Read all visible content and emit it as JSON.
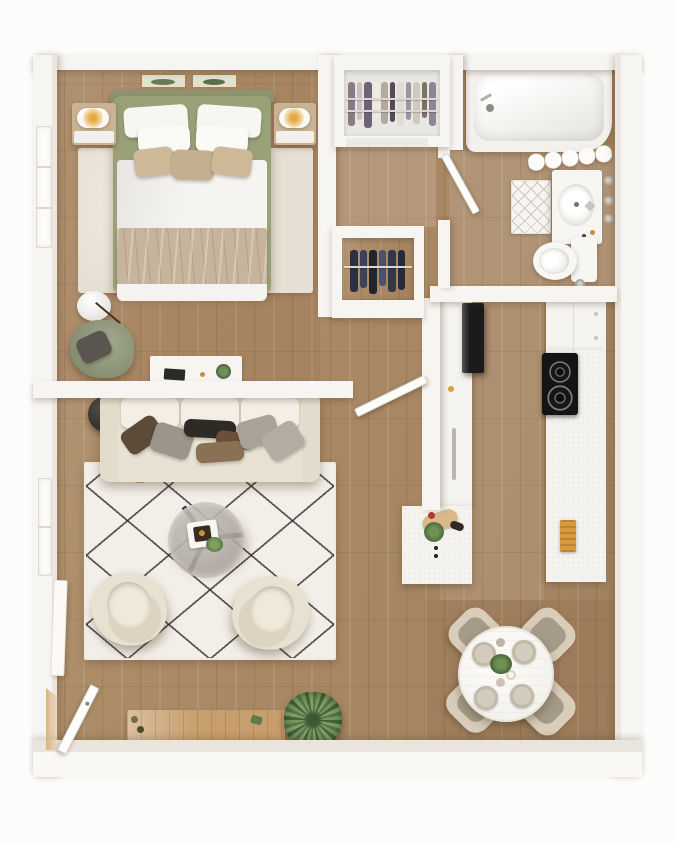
{
  "colors": {
    "page_bg": "#fcfcfb",
    "wall": "#f7f5f2",
    "wall_shade": "#ebe7df",
    "wood_base": "#ac8b67",
    "rug_bedroom": "#e6dfd3",
    "rug_living": "#f2efe8",
    "rug_pattern": "#2a2723",
    "sofa": "#e9e2d4",
    "bed_frame": "#9aa178",
    "bedding": "#f5f4f0",
    "blanket": "#c6b49c",
    "armchair_green": "#8d9674",
    "accent_chair": "#e8e1d2",
    "console_wood": "#c79e6d",
    "plant_green": "#5d7d4c",
    "appliance_dark": "#1b1b1d",
    "towel_orange": "#d89a3e",
    "counter_white": "#f4f3ef",
    "dining_chair": "#d8cdba",
    "table_white": "#f4f2ed",
    "lamp_glow": "#e8a93f",
    "clothes_navy": "#333a4d",
    "door_white": "#fdfdfb"
  },
  "scene": {
    "type": "apartment-floor-plan-3d-top-view",
    "rooms": [
      "bedroom",
      "closet",
      "hallway",
      "walk-in-closet",
      "bathroom",
      "kitchen",
      "living-room",
      "dining-area"
    ],
    "bedroom_items": [
      "double-bed",
      "headboard-bench",
      "wall-art",
      "nightstand-left",
      "nightstand-right",
      "table-lamp-left",
      "table-lamp-right",
      "area-rug",
      "side-table",
      "reading-chair",
      "desk",
      "desk-plant",
      "window",
      "bedroom-door"
    ],
    "closet_items": [
      "hanging-clothes",
      "closet-rod"
    ],
    "bathroom_items": [
      "bathtub",
      "shower-curtain",
      "bath-mat",
      "vanity-sink",
      "faucet",
      "wall-hooks",
      "toilet",
      "floor-drain",
      "bathroom-door"
    ],
    "kitchen_items": [
      "refrigerator",
      "counter-left",
      "sink",
      "kitchen-island",
      "cutting-board",
      "herb-plant",
      "upper-cabinets",
      "cooktop",
      "counter-right",
      "oven-towel"
    ],
    "living_items": [
      "sofa",
      "throw-pillows",
      "side-table",
      "arc-floor-lamp",
      "area-rug",
      "coffee-table",
      "serving-tray",
      "accent-chair-left",
      "accent-chair-right",
      "media-console",
      "potted-plant",
      "entry-door",
      "window"
    ],
    "dining_items": [
      "round-dining-table",
      "dining-chair",
      "place-setting",
      "centerpiece-plant"
    ]
  }
}
